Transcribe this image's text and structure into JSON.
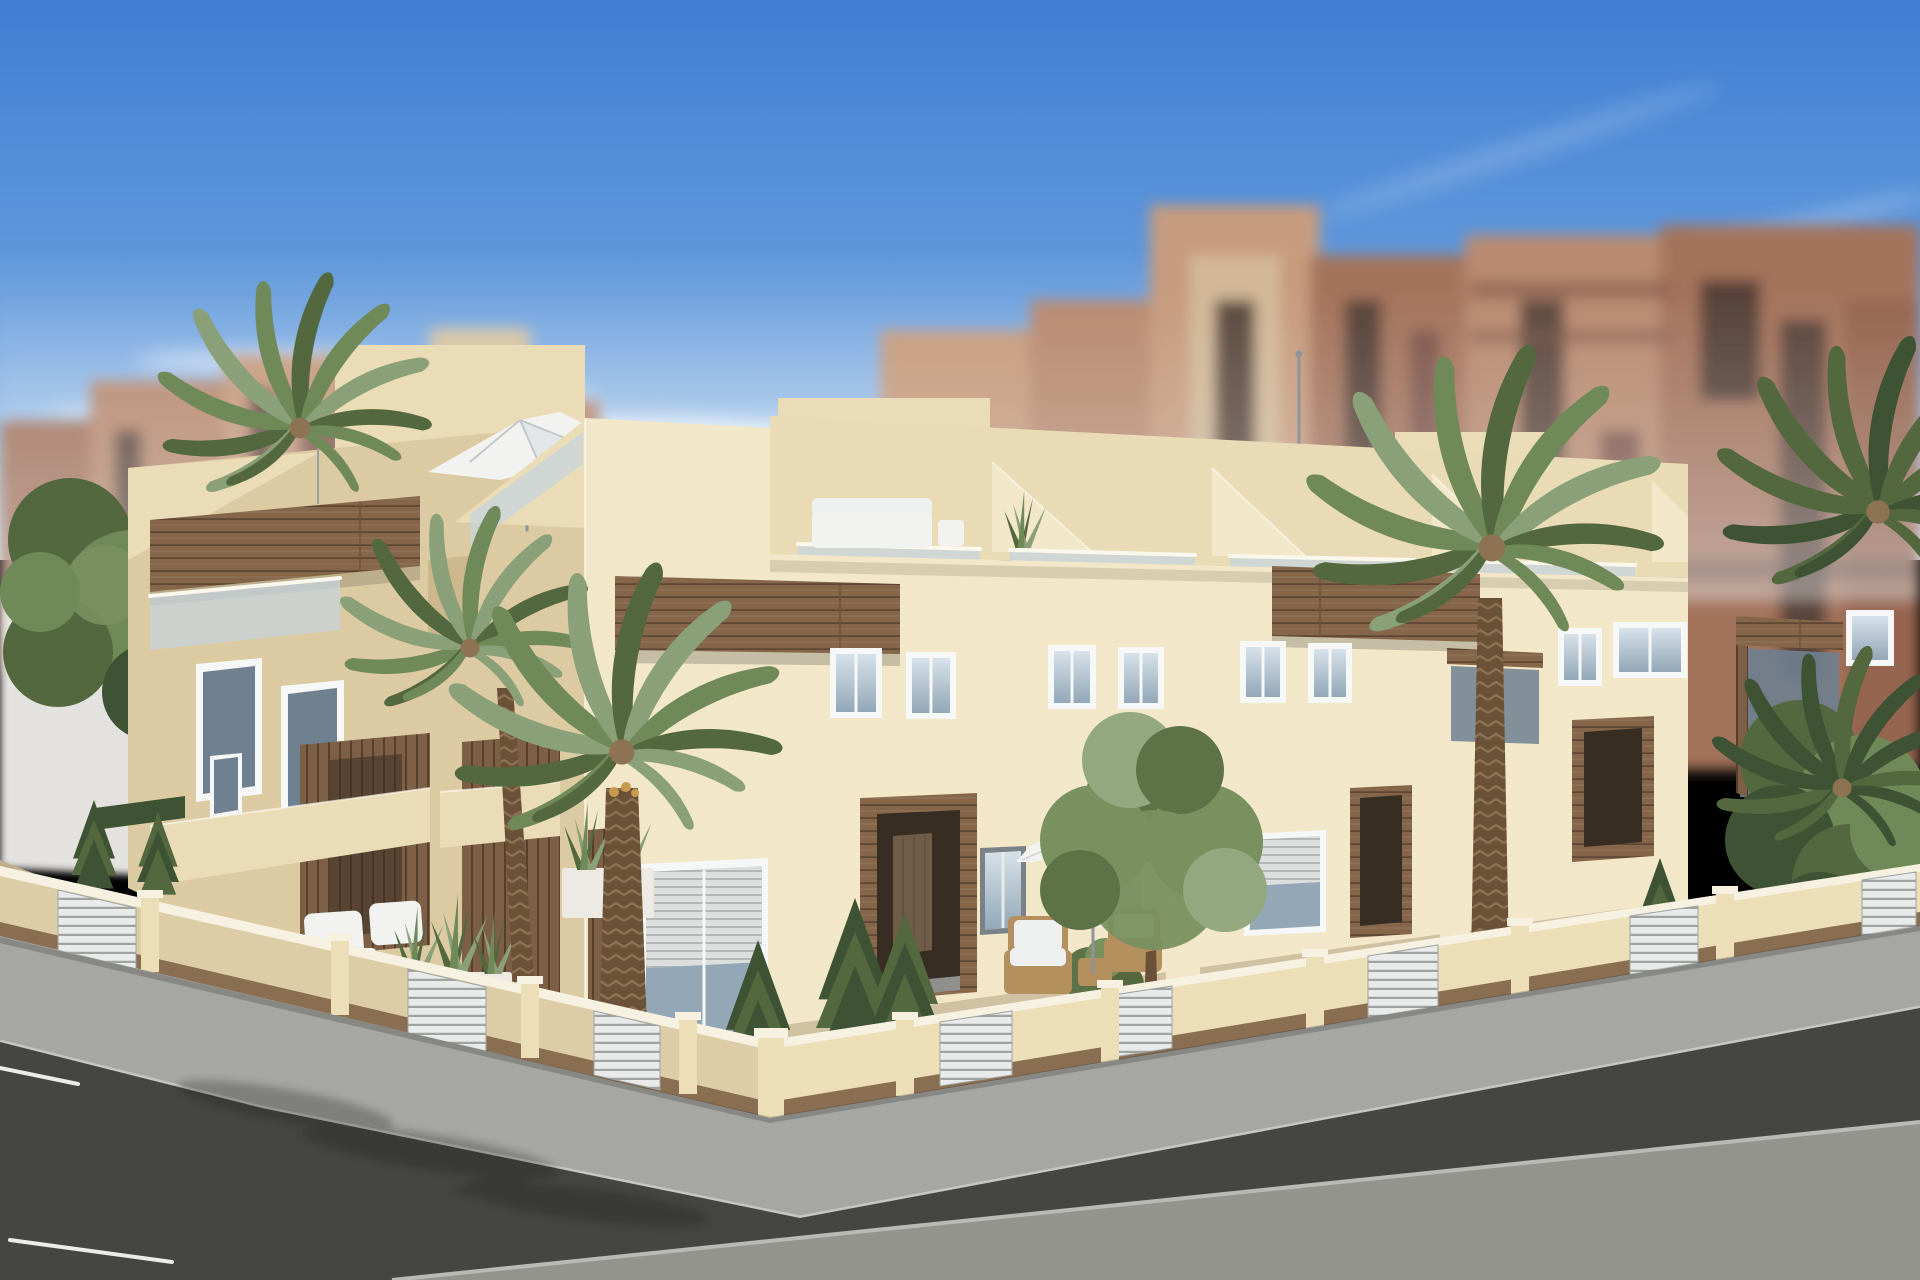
{
  "meta": {
    "kind": "3d-architectural-render",
    "subject": "New-build Mediterranean townhouse block on a street corner",
    "width_px": 1920,
    "height_px": 1280,
    "contains_text": false
  },
  "scene": {
    "sky": "clear blue sky, brighter toward horizon, thin white cloud wisps",
    "background": "out-of-focus terracotta and beige apartment towers with dark balcony slots (tilt-shift blur)",
    "midground": "blurred white boundary wall at far left",
    "building": {
      "style": "modern 3-storey cream stucco townhouses, flat roofs with sloped parapets",
      "features": [
        "rooftop terraces with glass balustrades and sloped parapet dividers",
        "cantilevered white parasol on left roof terrace",
        "white outdoor sofa on corner roof terrace",
        "aloe plant on second roof terrace",
        "horizontal wood-clad fascia bands and balcony boxes",
        "white-framed windows, one with half-closed roller shutter",
        "recessed entrance portals with dark timber surrounds",
        "wood slat cladding panels at ground floor",
        "roof antenna pole"
      ],
      "units_visible": 6
    },
    "gardens": {
      "enclosure": "low cream perimeter wall, white coping, timber base strip, white louvre gate panels",
      "plants": [
        "phoenix palms",
        "washingtonia palm",
        "olive tree",
        "columnar conifers",
        "sansevieria planters",
        "lavender planter",
        "hedge strips"
      ],
      "furniture": [
        "white patio chairs and table",
        "rattan armchairs with white cushions",
        "white garden parasol"
      ]
    },
    "street": {
      "elements": [
        "light grey sidewalk with curb",
        "dark asphalt roadway",
        "white parking bay lines",
        "light concrete foreground pavement",
        "palm frond shadows on paving"
      ]
    }
  },
  "palette": {
    "skyTop": "#3f7ed2",
    "skyMid": "#5f97dc",
    "skyLow": "#a8c8ea",
    "skyHaze": "#dfeaf5",
    "cloud": "#f5f8fb",
    "bgWarm1": "#b98a70",
    "bgWarm2": "#a4735c",
    "bgWarm3": "#c79b7d",
    "bgWarm4": "#96654f",
    "bgBeige": "#d8c5a4",
    "bgSlot": "#4e3c34",
    "bgSlot2": "#7e564a",
    "midWall": "#e3e2de",
    "cream1": "#f2e7c8",
    "cream2": "#eadcb6",
    "cream3": "#dccaa2",
    "cream4": "#cdb78c",
    "band": "#e9dbb5",
    "edgeWhite": "#faf7ec",
    "wood": "#85664a",
    "woodDark": "#5f4733",
    "woodMid": "#6e523c",
    "woodLight": "#94775a",
    "glass": "#c6d4df",
    "glassDark": "#6f8090",
    "winGlassTop": "#d7e2ea",
    "winGlassBot": "#93a7b7",
    "frameWhite": "#f6f7f7",
    "frameGray": "#7b8287",
    "door": "#382d23",
    "doorLeaf": "#6f5d49",
    "shutter": "#dcdedd",
    "shutterLine": "#b4b7b6",
    "patio": "#cfc1a1",
    "patioShade": "#bfae8e",
    "fenceLit": "#ecdfb8",
    "fenceShade": "#ddcda6",
    "coping": "#f6f1e1",
    "fenceBase": "#8a6e52",
    "gate": "#e9ebea",
    "gateLine": "#9fa3a1",
    "sidewalk": "#a6a6a2",
    "asphalt": "#454543",
    "pavement": "#94948f",
    "curb": "#c6c6c2",
    "roadLine": "#ebebe9",
    "green1": "#6f8a58",
    "green2": "#53683f",
    "green3": "#8aa078",
    "green4": "#3e5334",
    "olive1": "#79905f",
    "olive2": "#5d7347",
    "olive3": "#93a87e",
    "trunk": "#6b5138",
    "trunkLight": "#8d7354",
    "fruit": "#c59a4e",
    "wicker": "#b5905f",
    "cushion": "#eef0f0",
    "whiteFurn": "#f2f3f1",
    "planter": "#eceae2",
    "lavender": "#9b8fb6",
    "shadow": "#1a1a1a"
  }
}
